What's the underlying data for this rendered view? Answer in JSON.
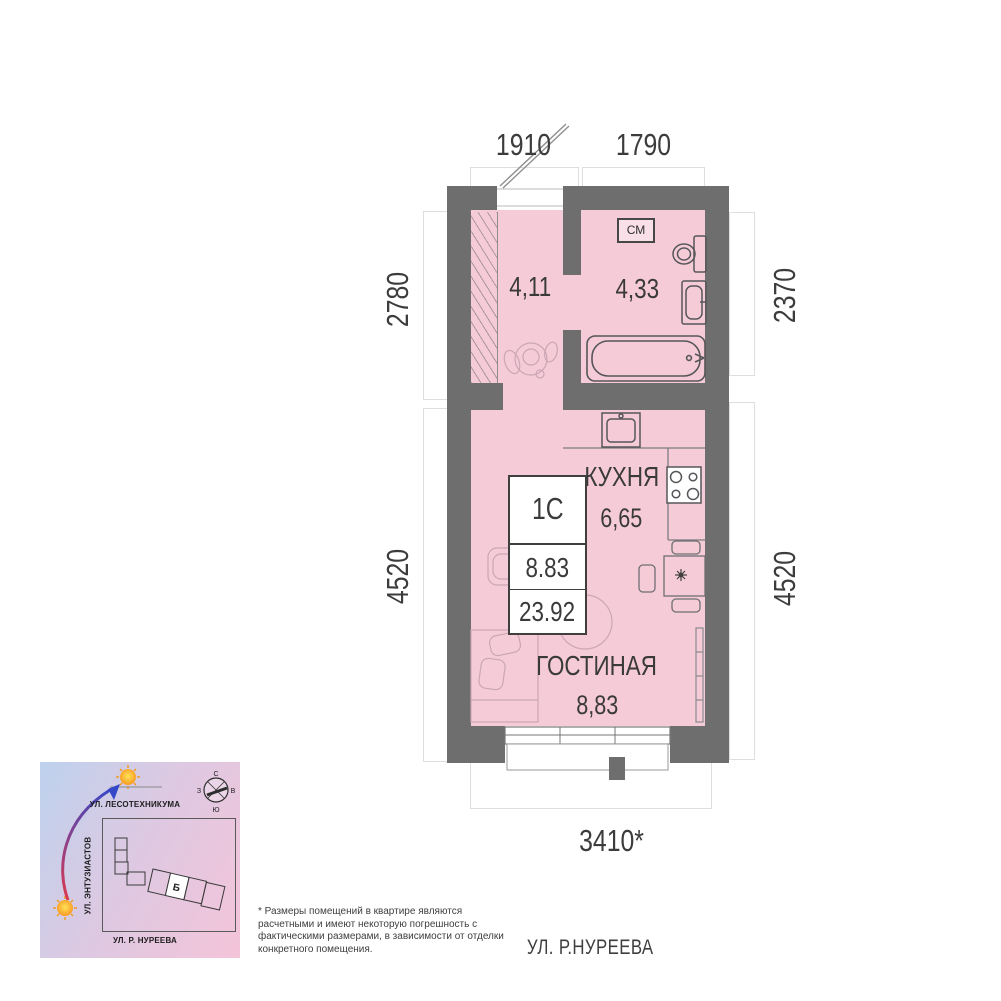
{
  "plan": {
    "dims": {
      "top_left": "1910",
      "top_right": "1790",
      "left_top": "2780",
      "left_bottom": "4520",
      "right_top": "2370",
      "right_bottom": "4520",
      "bottom": "3410*"
    },
    "rooms": {
      "hall_area": "4,11",
      "bath_area": "4,33",
      "washer_label": "СМ",
      "kitchen_label": "КУХНЯ",
      "kitchen_area": "6,65",
      "living_label": "ГОСТИНАЯ",
      "living_area": "8,83"
    },
    "info_box": {
      "type": "1С",
      "living_area": "8.83",
      "total_area": "23.92"
    },
    "colors": {
      "wall": "#6e6e6e",
      "room_fill": "#f5cbd7",
      "fixture_stroke": "#56565a",
      "soft_furniture_stroke": "#cba6b4",
      "dim_text": "#3c3c3c"
    }
  },
  "map": {
    "street_top": "УЛ. ЛЕСОТЕХНИКУМА",
    "street_left": "УЛ. ЭНТУЗИАСТОВ",
    "street_bottom": "УЛ. Р. НУРЕЕВА",
    "building_label": "Б",
    "compass": {
      "n": "С",
      "e": "В",
      "s": "Ю",
      "w": "З"
    },
    "colors": {
      "bg_from": "#bdd2ee",
      "bg_to": "#f4c4d9",
      "arrow_from": "#d83a52",
      "arrow_to": "#3448c8",
      "sun": "#f7a823"
    }
  },
  "footnote": "* Размеры помещений в квартире являются расчетными и имеют некоторую погрешность с фактическими размерами, в зависимости от отделки конкретного помещения.",
  "street_label": "УЛ. Р.НУРЕЕВА"
}
